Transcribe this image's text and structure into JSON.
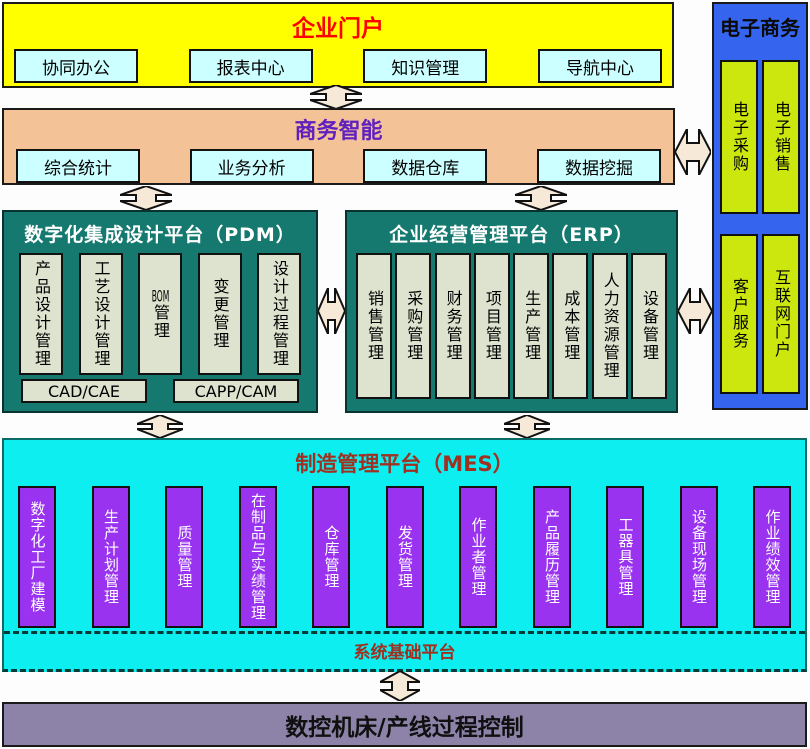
{
  "colors": {
    "portal_bg": "#ffff00",
    "portal_title": "#ff0000",
    "bi_bg": "#f3c296",
    "bi_title": "#6020c0",
    "item_bg": "#ccffff",
    "platform_bg": "#15796f",
    "platform_column_bg": "#dde3cf",
    "ecommerce_bg": "#3565ef",
    "ecommerce_item_bg": "#cbe70e",
    "mes_bg": "#0ceef0",
    "mes_title": "#a03020",
    "mes_column_bg": "#9933f0",
    "control_bg": "#8d83a9",
    "arrow_fill": "#f7e9d7"
  },
  "portal": {
    "title": "企业门户",
    "items": [
      "协同办公",
      "报表中心",
      "知识管理",
      "导航中心"
    ]
  },
  "bi": {
    "title": "商务智能",
    "items": [
      "综合统计",
      "业务分析",
      "数据仓库",
      "数据挖掘"
    ]
  },
  "ecommerce": {
    "title": "电子商务",
    "top_items": [
      "电子采购",
      "电子销售"
    ],
    "bottom_items": [
      "客户服务",
      "互联网门户"
    ]
  },
  "pdm": {
    "title": "数字化集成设计平台（PDM）",
    "columns": [
      "产品设计管理",
      "工艺设计管理",
      "BOM管理",
      "变更管理",
      "设计过程管理"
    ],
    "tools": [
      "CAD/CAE",
      "CAPP/CAM"
    ]
  },
  "erp": {
    "title": "企业经营管理平台（ERP）",
    "columns": [
      "销售管理",
      "采购管理",
      "财务管理",
      "项目管理",
      "生产管理",
      "成本管理",
      "人力资源管理",
      "设备管理"
    ]
  },
  "mes": {
    "title": "制造管理平台（MES）",
    "columns": [
      "数字化工厂建模",
      "生产计划管理",
      "质量管理",
      "在制品与实绩管理",
      "仓库管理",
      "发货管理",
      "作业者管理",
      "产品履历管理",
      "工器具管理",
      "设备现场管理",
      "作业绩效管理"
    ],
    "base_platform_label": "系统基础平台"
  },
  "process_control": {
    "label": "数控机床/产线过程控制"
  }
}
